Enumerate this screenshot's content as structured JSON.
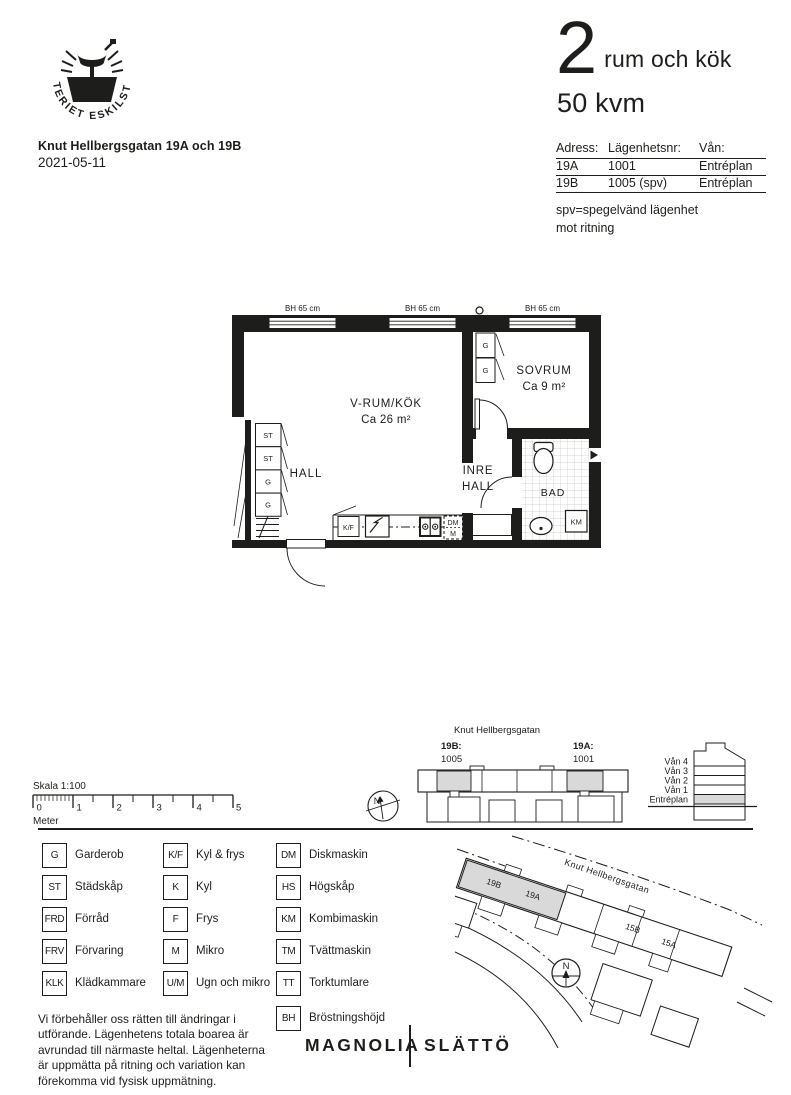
{
  "page": {
    "bg": "#ffffff",
    "ink": "#1d1d1b",
    "gray": "#d9d9d9"
  },
  "logo": {
    "circle_text": "GJUTERIET ESKILSTUNA",
    "letter": "G"
  },
  "header": {
    "title": "Knut Hellbergsgatan 19A och 19B",
    "date": "2021-05-11",
    "rooms_number": "2",
    "rooms_label": "rum och kök",
    "area": "50 kvm",
    "table": {
      "col_adress": "Adress:",
      "col_nr": "Lägenhetsnr:",
      "col_van": "Vån:",
      "rows": [
        {
          "adress": "19A",
          "nr": "1001",
          "van": "Entréplan"
        },
        {
          "adress": "19B",
          "nr": "1005 (spv)",
          "van": "Entréplan"
        }
      ]
    },
    "note_line1": "spv=spegelvänd lägenhet",
    "note_line2": "mot ritning"
  },
  "floorplan": {
    "windows": [
      "BH 65 cm",
      "BH 65 cm",
      "BH 65 cm"
    ],
    "rooms": {
      "vrum_name": "V-RUM/KÖK",
      "vrum_area": "Ca 26 m²",
      "sovrum_name": "SOVRUM",
      "sovrum_area": "Ca 9 m²",
      "hall": "HALL",
      "inre_line1": "INRE",
      "inre_line2": "HALL",
      "bad": "BAD"
    },
    "closets": [
      "ST",
      "ST",
      "G",
      "G"
    ],
    "sovrum_closets": [
      "G",
      "G"
    ],
    "fixtures": {
      "kf": "K/F",
      "dm": "DM",
      "m": "M",
      "km": "KM"
    }
  },
  "scalebar": {
    "title": "Skala 1:100",
    "unit": "Meter",
    "ticks": [
      "0",
      "1",
      "2",
      "3",
      "4",
      "5"
    ]
  },
  "overview": {
    "street": "Knut Hellbergsgatan",
    "left_label": "19B:",
    "left_number": "1005",
    "right_label": "19A:",
    "right_number": "1001",
    "compass": "N"
  },
  "elevation": {
    "floors": [
      "Vån 4",
      "Vån 3",
      "Vån 2",
      "Vån 1",
      "Entréplan"
    ]
  },
  "legend": {
    "items": [
      {
        "abbr": "G",
        "label": "Garderob"
      },
      {
        "abbr": "ST",
        "label": "Städskåp"
      },
      {
        "abbr": "FRD",
        "label": "Förråd"
      },
      {
        "abbr": "FRV",
        "label": "Förvaring"
      },
      {
        "abbr": "KLK",
        "label": "Klädkammare"
      },
      {
        "abbr": "K/F",
        "label": "Kyl & frys"
      },
      {
        "abbr": "K",
        "label": "Kyl"
      },
      {
        "abbr": "F",
        "label": "Frys"
      },
      {
        "abbr": "M",
        "label": "Mikro"
      },
      {
        "abbr": "U/M",
        "label": "Ugn och mikro"
      },
      {
        "abbr": "DM",
        "label": "Diskmaskin"
      },
      {
        "abbr": "HS",
        "label": "Högskåp"
      },
      {
        "abbr": "KM",
        "label": "Kombimaskin"
      },
      {
        "abbr": "TM",
        "label": "Tvättmaskin"
      },
      {
        "abbr": "TT",
        "label": "Torktumlare"
      },
      {
        "abbr": "BH",
        "label": "Bröstningshöjd"
      }
    ]
  },
  "disclaimer": {
    "lines": [
      "Vi förbehåller oss rätten till ändringar i",
      "utförande. Lägenhetens totala boarea är",
      "avrundad till närmaste heltal. Lägenheterna",
      "är uppmätta på ritning och variation kan",
      "förekomma vid fysisk uppmätning."
    ]
  },
  "sitemap": {
    "street": "Knut Hellbergsgatan",
    "b19b": "19B",
    "b19a": "19A",
    "b15b": "15B",
    "b15a": "15A",
    "compass": "N"
  },
  "footer": {
    "brand_left": "MAGNOLIA",
    "brand_right": "SLÄTTÖ"
  }
}
